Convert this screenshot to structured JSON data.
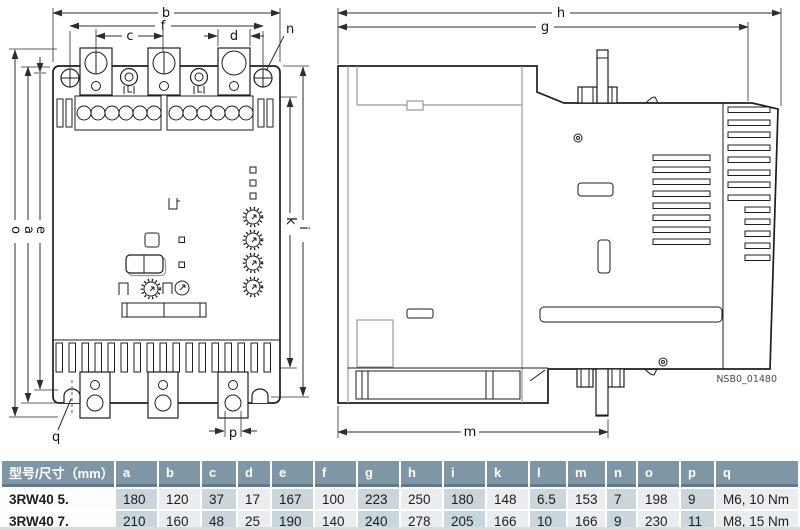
{
  "figure": {
    "front_view": {
      "labels": {
        "b": "b",
        "f": "f",
        "c": "c",
        "d": "d",
        "n": "n",
        "o": "o",
        "a": "a",
        "e": "e",
        "k": "k",
        "i": "i",
        "q": "q",
        "p": "p"
      }
    },
    "side_view": {
      "labels": {
        "h": "h",
        "g": "g",
        "m": "m"
      },
      "code": "NSB0_01480"
    }
  },
  "table": {
    "header": [
      "型号/尺寸（mm）",
      "a",
      "b",
      "c",
      "d",
      "e",
      "f",
      "g",
      "h",
      "i",
      "k",
      "l",
      "m",
      "n",
      "o",
      "p",
      "q"
    ],
    "rows": [
      {
        "model": "3RW40 5.",
        "values": [
          "180",
          "120",
          "37",
          "17",
          "167",
          "100",
          "223",
          "250",
          "180",
          "148",
          "6.5",
          "153",
          "7",
          "198",
          "9",
          "M6, 10 Nm"
        ]
      },
      {
        "model": "3RW40 7.",
        "values": [
          "210",
          "160",
          "48",
          "25",
          "190",
          "140",
          "240",
          "278",
          "205",
          "166",
          "10",
          "166",
          "9",
          "230",
          "11",
          "M8, 15 Nm"
        ]
      }
    ]
  },
  "colors": {
    "table_header_bg": "#7E96A5",
    "table_header_text": "#FFFFFF",
    "cell_light": "#E9EDF0",
    "cell_dark": "#CBD6DC",
    "model_cell_bg": "#FCFDFD",
    "line": "#1E1E1E"
  }
}
